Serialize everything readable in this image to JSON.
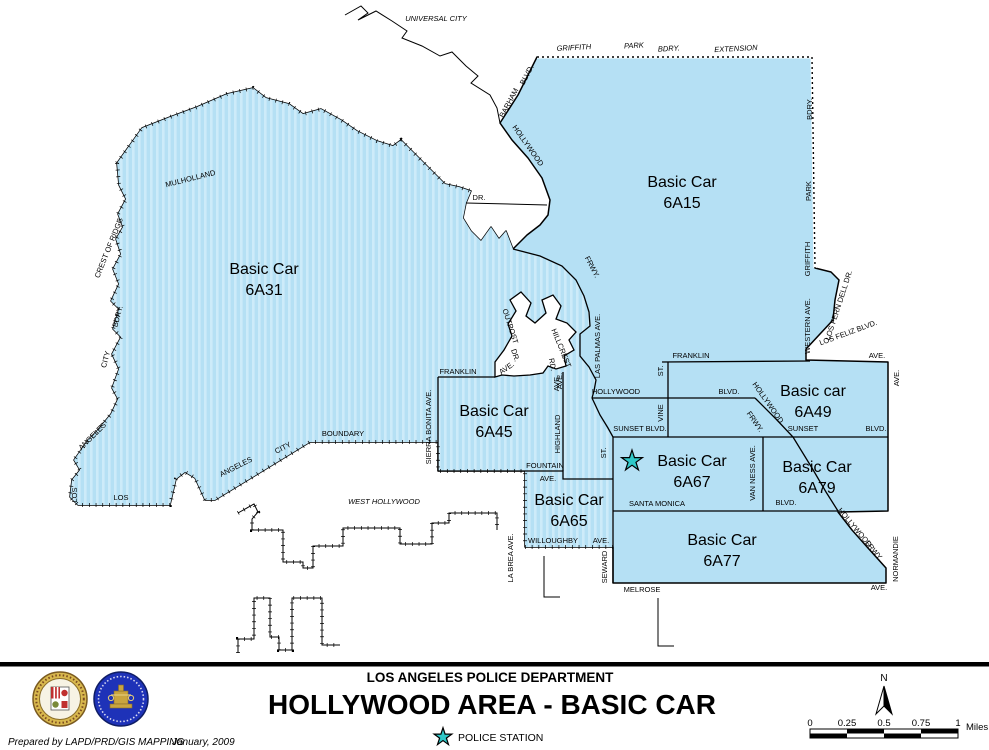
{
  "map": {
    "colors": {
      "area_fill": "#b5e0f4",
      "stripe": "#cdebf9",
      "star": "#2fc8c8",
      "outline": "#000000"
    },
    "police_station": {
      "x": 632,
      "y": 461
    },
    "region_titles": [
      {
        "line1": "Basic Car",
        "line2": "6A31",
        "x": 264,
        "y": 274
      },
      {
        "line1": "Basic Car",
        "line2": "6A15",
        "x": 682,
        "y": 187
      },
      {
        "line1": "Basic Car",
        "line2": "6A45",
        "x": 494,
        "y": 416
      },
      {
        "line1": "Basic car",
        "line2": "6A49",
        "x": 813,
        "y": 396
      },
      {
        "line1": "Basic Car",
        "line2": "6A67",
        "x": 692,
        "y": 466
      },
      {
        "line1": "Basic Car",
        "line2": "6A79",
        "x": 817,
        "y": 472
      },
      {
        "line1": "Basic Car",
        "line2": "6A65",
        "x": 569,
        "y": 505
      },
      {
        "line1": "Basic Car",
        "line2": "6A77",
        "x": 722,
        "y": 545
      }
    ],
    "street_labels": [
      {
        "t": "UNIVERSAL CITY",
        "x": 436,
        "y": 21,
        "r": 0,
        "s": 10,
        "i": 1
      },
      {
        "t": "GRIFFITH",
        "x": 574,
        "y": 50,
        "r": -3,
        "i": 1
      },
      {
        "t": "PARK",
        "x": 634,
        "y": 48,
        "r": -3,
        "i": 1
      },
      {
        "t": "BDRY.",
        "x": 669,
        "y": 51,
        "r": -3,
        "i": 1
      },
      {
        "t": "EXTENSION",
        "x": 736,
        "y": 51,
        "r": -3,
        "i": 1
      },
      {
        "t": "BARHAM",
        "x": 511,
        "y": 104,
        "r": -62
      },
      {
        "t": "BLVD.",
        "x": 529,
        "y": 76,
        "r": -62
      },
      {
        "t": "HOLLYWOOD",
        "x": 526,
        "y": 147,
        "r": 55
      },
      {
        "t": "FRWY.",
        "x": 590,
        "y": 268,
        "r": 62
      },
      {
        "t": "MULHOLLAND",
        "x": 191,
        "y": 181,
        "r": -14
      },
      {
        "t": "DR.",
        "x": 479,
        "y": 200,
        "r": 0
      },
      {
        "t": "CREST OF RIDGE",
        "x": 111,
        "y": 249,
        "r": -68
      },
      {
        "t": "BDRY.",
        "x": 120,
        "y": 317,
        "r": -75
      },
      {
        "t": "CITY",
        "x": 108,
        "y": 360,
        "r": -75
      },
      {
        "t": "ANGELES",
        "x": 94,
        "y": 438,
        "r": -45
      },
      {
        "t": "LOS",
        "x": 77,
        "y": 495,
        "r": -90
      },
      {
        "t": "LOS",
        "x": 121,
        "y": 500,
        "r": 0
      },
      {
        "t": "ANGELES",
        "x": 237,
        "y": 469,
        "r": -27
      },
      {
        "t": "CITY",
        "x": 284,
        "y": 450,
        "r": -27
      },
      {
        "t": "BOUNDARY",
        "x": 343,
        "y": 436,
        "r": 0
      },
      {
        "t": "WEST HOLLYWOOD",
        "x": 384,
        "y": 504,
        "r": 0,
        "i": 1
      },
      {
        "t": "SIERRA BONITA AVE.",
        "x": 431,
        "y": 427,
        "r": -90
      },
      {
        "t": "FRANKLIN",
        "x": 458,
        "y": 374,
        "r": 0
      },
      {
        "t": "AVE.",
        "x": 508,
        "y": 370,
        "r": -35
      },
      {
        "t": "OUTPOST",
        "x": 508,
        "y": 327,
        "r": 72
      },
      {
        "t": "DR.",
        "x": 513,
        "y": 356,
        "r": 72
      },
      {
        "t": "HILLCREST",
        "x": 559,
        "y": 349,
        "r": 68
      },
      {
        "t": "RD.",
        "x": 550,
        "y": 365,
        "r": 80
      },
      {
        "t": "AVE.",
        "x": 562,
        "y": 381,
        "r": -90
      },
      {
        "t": "LAS PALMAS AVE.",
        "x": 600,
        "y": 346,
        "r": -90,
        "s": 6
      },
      {
        "t": "ST.",
        "x": 663,
        "y": 371,
        "r": -90
      },
      {
        "t": "FRANKLIN",
        "x": 691,
        "y": 358,
        "r": 0
      },
      {
        "t": "AVE.",
        "x": 877,
        "y": 358,
        "r": 0
      },
      {
        "t": "AVE.",
        "x": 899,
        "y": 378,
        "r": -90
      },
      {
        "t": "WESTERN AVE.",
        "x": 810,
        "y": 326,
        "r": -90
      },
      {
        "t": "GRIFFITH",
        "x": 810,
        "y": 259,
        "r": -90
      },
      {
        "t": "PARK",
        "x": 811,
        "y": 191,
        "r": -90
      },
      {
        "t": "BDRY.",
        "x": 812,
        "y": 109,
        "r": -90
      },
      {
        "t": "LOS FERN DELL DR.",
        "x": 841,
        "y": 306,
        "r": -72,
        "s": 7
      },
      {
        "t": "LOS FELIZ BLVD.",
        "x": 849,
        "y": 335,
        "r": -20
      },
      {
        "t": "HOLLYWOOD",
        "x": 616,
        "y": 394,
        "r": 0
      },
      {
        "t": "BLVD.",
        "x": 729,
        "y": 394,
        "r": 0
      },
      {
        "t": "VINE",
        "x": 663,
        "y": 413,
        "r": -90
      },
      {
        "t": "ST.",
        "x": 606,
        "y": 453,
        "r": -90
      },
      {
        "t": "SUNSET BLVD.",
        "x": 640,
        "y": 431,
        "r": 0
      },
      {
        "t": "HOLLYWOOD",
        "x": 766,
        "y": 404,
        "r": 55
      },
      {
        "t": "FRWY.",
        "x": 753,
        "y": 423,
        "r": 55
      },
      {
        "t": "SUNSET",
        "x": 803,
        "y": 431,
        "r": 0
      },
      {
        "t": "BLVD.",
        "x": 876,
        "y": 431,
        "r": 0
      },
      {
        "t": "VAN NESS AVE.",
        "x": 755,
        "y": 473,
        "r": -90
      },
      {
        "t": "SANTA MONICA",
        "x": 657,
        "y": 506,
        "r": 0
      },
      {
        "t": "BLVD.",
        "x": 786,
        "y": 505,
        "r": 0
      },
      {
        "t": "HOLLYWOOD",
        "x": 853,
        "y": 529,
        "r": 50
      },
      {
        "t": "FRWY.",
        "x": 872,
        "y": 552,
        "r": 50
      },
      {
        "t": "NORMANDIE",
        "x": 898,
        "y": 559,
        "r": -90
      },
      {
        "t": "SEWARD",
        "x": 607,
        "y": 567,
        "r": -90
      },
      {
        "t": "MELROSE",
        "x": 642,
        "y": 592,
        "r": 0
      },
      {
        "t": "AVE.",
        "x": 879,
        "y": 590,
        "r": 0
      },
      {
        "t": "FOUNTAIN",
        "x": 545,
        "y": 468,
        "r": 0
      },
      {
        "t": "AVE.",
        "x": 548,
        "y": 481,
        "r": 0
      },
      {
        "t": "WILLOUGHBY",
        "x": 553,
        "y": 543,
        "r": 0
      },
      {
        "t": "AVE.",
        "x": 601,
        "y": 543,
        "r": 0
      },
      {
        "t": "LA BREA AVE.",
        "x": 513,
        "y": 558,
        "r": -90
      },
      {
        "t": "AVE.",
        "x": 559,
        "y": 383,
        "r": -90
      },
      {
        "t": "HIGHLAND",
        "x": 560,
        "y": 434,
        "r": -90
      }
    ]
  },
  "footer": {
    "department": "LOS ANGELES POLICE DEPARTMENT",
    "title": "HOLLYWOOD AREA - BASIC CAR",
    "legend_label": "POLICE STATION",
    "prepared_by": "Prepared by LAPD/PRD/GIS MAPPING",
    "date": "January, 2009",
    "north_label": "N",
    "scale": {
      "ticks": [
        "0",
        "0.25",
        "0.5",
        "0.75",
        "1"
      ],
      "unit": "Miles"
    }
  }
}
